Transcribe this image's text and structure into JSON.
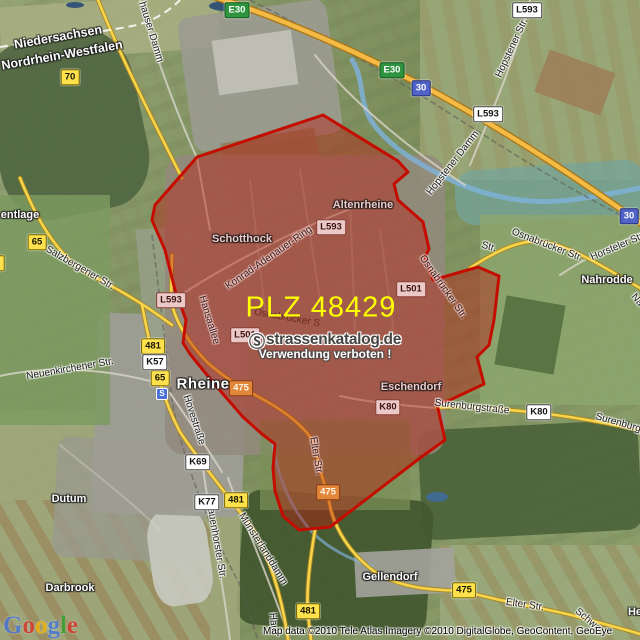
{
  "map": {
    "title": "PLZ 48429 Rheine postal code area map",
    "overlay": {
      "plz_label": "PLZ 48429",
      "plz_color": "#ffff00",
      "boundary_color": "#c40d00",
      "fill_color": "rgba(185,25,15,0.43)",
      "polygon_points": "197,157 323,115 398,161 408,172 394,184 398,200 423,222 429,249 425,257 433,280 478,267 499,276 494,320 489,345 477,357 484,384 450,400 437,404 445,440 420,458 330,527 299,530 283,516 275,491 273,468 275,444 262,434 243,417 223,394 207,375 190,354 183,343 186,320 175,290 165,250 152,220 155,205"
    },
    "watermark": {
      "symbol": "Ⓢ",
      "site": "strassenkatalog.de",
      "notice": "Verwendung verboten !"
    },
    "station_label": "S",
    "attribution": "Map data ©2010 Tele Atlas  Imagery ©2010 DigitalGlobe, GeoContent, GeoEye",
    "logo_letters": [
      {
        "ch": "G",
        "color": "#4475d8"
      },
      {
        "ch": "o",
        "color": "#d7332a"
      },
      {
        "ch": "o",
        "color": "#f3b400"
      },
      {
        "ch": "g",
        "color": "#4475d8"
      },
      {
        "ch": "l",
        "color": "#30a030"
      },
      {
        "ch": "e",
        "color": "#d7332a"
      }
    ],
    "colors": {
      "highway": "#f3ba45",
      "road_yellow": "#f7d44c",
      "water": "#7fb2d8"
    }
  },
  "layers": [
    {
      "name": "region-label",
      "cls": "region",
      "items": [
        {
          "t": "Niedersachsen",
          "x": 58,
          "y": 37,
          "r": -10
        },
        {
          "t": "Nordrhein-Westfalen",
          "x": 62,
          "y": 55,
          "r": -10
        }
      ]
    },
    {
      "name": "place-label",
      "cls": "place",
      "items": [
        {
          "t": "entlage",
          "x": 20,
          "y": 215
        },
        {
          "t": "Schotthock",
          "x": 242,
          "y": 239,
          "cls": "tint"
        },
        {
          "t": "Altenrheine",
          "x": 363,
          "y": 205,
          "cls": "tint"
        },
        {
          "t": "Rheine",
          "x": 203,
          "y": 384,
          "cls": "big"
        },
        {
          "t": "Eschendorf",
          "x": 411,
          "y": 387,
          "cls": "tint"
        },
        {
          "t": "Nahrodde",
          "x": 607,
          "y": 280
        },
        {
          "t": "Dutum",
          "x": 69,
          "y": 499
        },
        {
          "t": "Darbrook",
          "x": 70,
          "y": 588
        },
        {
          "t": "Gellendorf",
          "x": 390,
          "y": 577
        },
        {
          "t": "He",
          "x": 635,
          "y": 612
        }
      ]
    },
    {
      "name": "street-label",
      "cls": "street",
      "items": [
        {
          "t": "hauser Damm",
          "x": 151,
          "y": 32,
          "r": 73
        },
        {
          "t": "Hopstener Str.",
          "x": 512,
          "y": 48,
          "r": -65
        },
        {
          "t": "Hopstener Damm",
          "x": 453,
          "y": 163,
          "r": -52
        },
        {
          "t": "Osnabrücker Str.",
          "x": 547,
          "y": 245,
          "r": 21
        },
        {
          "t": "Str.",
          "x": 489,
          "y": 247,
          "r": 15
        },
        {
          "t": "Horsteler Str",
          "x": 617,
          "y": 247,
          "r": -23
        },
        {
          "t": "Na",
          "x": 637,
          "y": 300,
          "r": 50
        },
        {
          "t": "Osnabrücker Str.",
          "x": 443,
          "y": 287,
          "r": 55,
          "cls": "tintS"
        },
        {
          "t": "Osnabrücker S",
          "x": 287,
          "y": 318,
          "r": 10,
          "cls": "ghost"
        },
        {
          "t": "Konrad-Adenauer-Ring",
          "x": 269,
          "y": 258,
          "r": -35,
          "cls": "tintS"
        },
        {
          "t": "Salzbergener Str.",
          "x": 80,
          "y": 268,
          "r": 30
        },
        {
          "t": "Neuenkirchener Str.",
          "x": 70,
          "y": 369,
          "r": -10
        },
        {
          "t": "Hansaallee",
          "x": 209,
          "y": 320,
          "r": 73,
          "cls": "tintS"
        },
        {
          "t": "Hovestraße",
          "x": 194,
          "y": 420,
          "r": 72
        },
        {
          "t": "Hauenhorster Str.",
          "x": 216,
          "y": 540,
          "r": 80
        },
        {
          "t": "Münsterlanddamm",
          "x": 263,
          "y": 549,
          "r": 58
        },
        {
          "t": "Elter Str.",
          "x": 316,
          "y": 456,
          "r": 80,
          "cls": "tintS"
        },
        {
          "t": "Elter Str.",
          "x": 525,
          "y": 605,
          "r": 8
        },
        {
          "t": "Schwa",
          "x": 588,
          "y": 620,
          "r": 40
        },
        {
          "t": "Hau",
          "x": 273,
          "y": 622,
          "r": 85
        },
        {
          "t": "Surenburgstraße",
          "x": 472,
          "y": 407,
          "r": 6
        },
        {
          "t": "Surenburgst",
          "x": 622,
          "y": 424,
          "r": 16
        }
      ]
    },
    {
      "name": "route-badge",
      "cls": "b",
      "items": [
        {
          "t": "E30",
          "x": 237,
          "y": 10,
          "cls": "b-green"
        },
        {
          "t": "E30",
          "x": 392,
          "y": 70,
          "cls": "b-green"
        },
        {
          "t": "30",
          "x": 421,
          "y": 88,
          "cls": "b-blue"
        },
        {
          "t": "30",
          "x": 629,
          "y": 216,
          "cls": "b-blue"
        },
        {
          "t": "L593",
          "x": 527,
          "y": 10,
          "cls": "b-white"
        },
        {
          "t": "L593",
          "x": 488,
          "y": 114,
          "cls": "b-white"
        },
        {
          "t": "70",
          "x": 70,
          "y": 77,
          "cls": "b-yellow"
        },
        {
          "t": "70",
          "x": -5,
          "y": 263,
          "cls": "b-yellow"
        },
        {
          "t": "65",
          "x": 37,
          "y": 242,
          "cls": "b-yellow"
        },
        {
          "t": "65",
          "x": 160,
          "y": 378,
          "cls": "b-yellow"
        },
        {
          "t": "481",
          "x": 153,
          "y": 346,
          "cls": "b-yellow"
        },
        {
          "t": "481",
          "x": 236,
          "y": 500,
          "cls": "b-yellow"
        },
        {
          "t": "481",
          "x": 308,
          "y": 611,
          "cls": "b-yellow"
        },
        {
          "t": "475",
          "x": 241,
          "y": 388,
          "cls": "b-orange"
        },
        {
          "t": "475",
          "x": 328,
          "y": 492,
          "cls": "b-orange"
        },
        {
          "t": "475",
          "x": 464,
          "y": 590,
          "cls": "b-yellow"
        },
        {
          "t": "K57",
          "x": 155,
          "y": 362,
          "cls": "b-white"
        },
        {
          "t": "K69",
          "x": 198,
          "y": 462,
          "cls": "b-white"
        },
        {
          "t": "K77",
          "x": 207,
          "y": 502,
          "cls": "b-white"
        },
        {
          "t": "K80",
          "x": 388,
          "y": 407,
          "cls": "b-pink"
        },
        {
          "t": "K80",
          "x": 539,
          "y": 412,
          "cls": "b-white"
        },
        {
          "t": "L593",
          "x": 171,
          "y": 300,
          "cls": "b-pink"
        },
        {
          "t": "L593",
          "x": 331,
          "y": 227,
          "cls": "b-pink"
        },
        {
          "t": "L501",
          "x": 411,
          "y": 289,
          "cls": "b-pink"
        },
        {
          "t": "L501",
          "x": 245,
          "y": 335,
          "cls": "b-pink"
        }
      ]
    }
  ]
}
